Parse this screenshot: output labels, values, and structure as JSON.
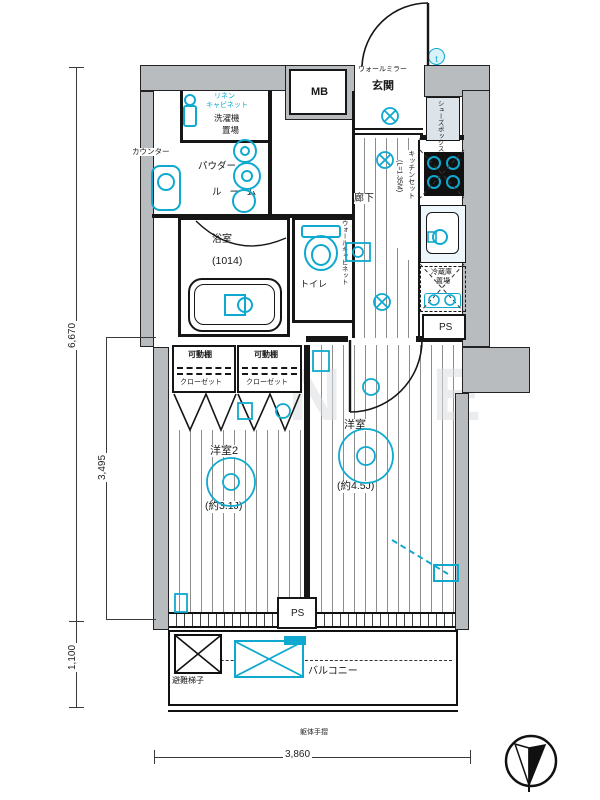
{
  "labels": {
    "wall_mirror": "ウォールミラー",
    "entrance": "玄関",
    "shoes_box": "シューズボックス",
    "meter_box": "MB",
    "doorbell": "t",
    "linen_cabinet_1": "リネン",
    "linen_cabinet_2": "キャビネット",
    "laundry_1": "洗濯機",
    "laundry_2": "置場",
    "counter": "カウンター",
    "powder_room_1": "パウダー",
    "powder_room_2": "ルーム",
    "bathroom": "浴室",
    "bathroom_size": "(1014)",
    "toilet": "トイレ",
    "wall_cabinet": "ウォールキャビネット",
    "hallway": "廊下",
    "kitchen_set": "キッチンセット",
    "kitchen_len": "(L=1.35M)",
    "fridge_1": "冷蔵庫",
    "fridge_2": "置場",
    "ps": "PS",
    "closet_shelf": "可動棚",
    "closet": "クローゼット",
    "room2": "洋室2",
    "room2_size": "(約3.1J)",
    "room1": "洋室",
    "room1_size": "(約4.5J)",
    "evac_ladder": "避難梯子",
    "balcony": "バルコニー",
    "handrail": "躯体手摺"
  },
  "dimensions": {
    "left_total": "6,670",
    "left_room": "3,495",
    "left_balcony": "1,100",
    "bottom": "3,860"
  },
  "watermark": {
    "letters": [
      "N",
      "E"
    ]
  },
  "colors": {
    "accent": "#0fa9cf",
    "wall": "#b9bcbe"
  }
}
